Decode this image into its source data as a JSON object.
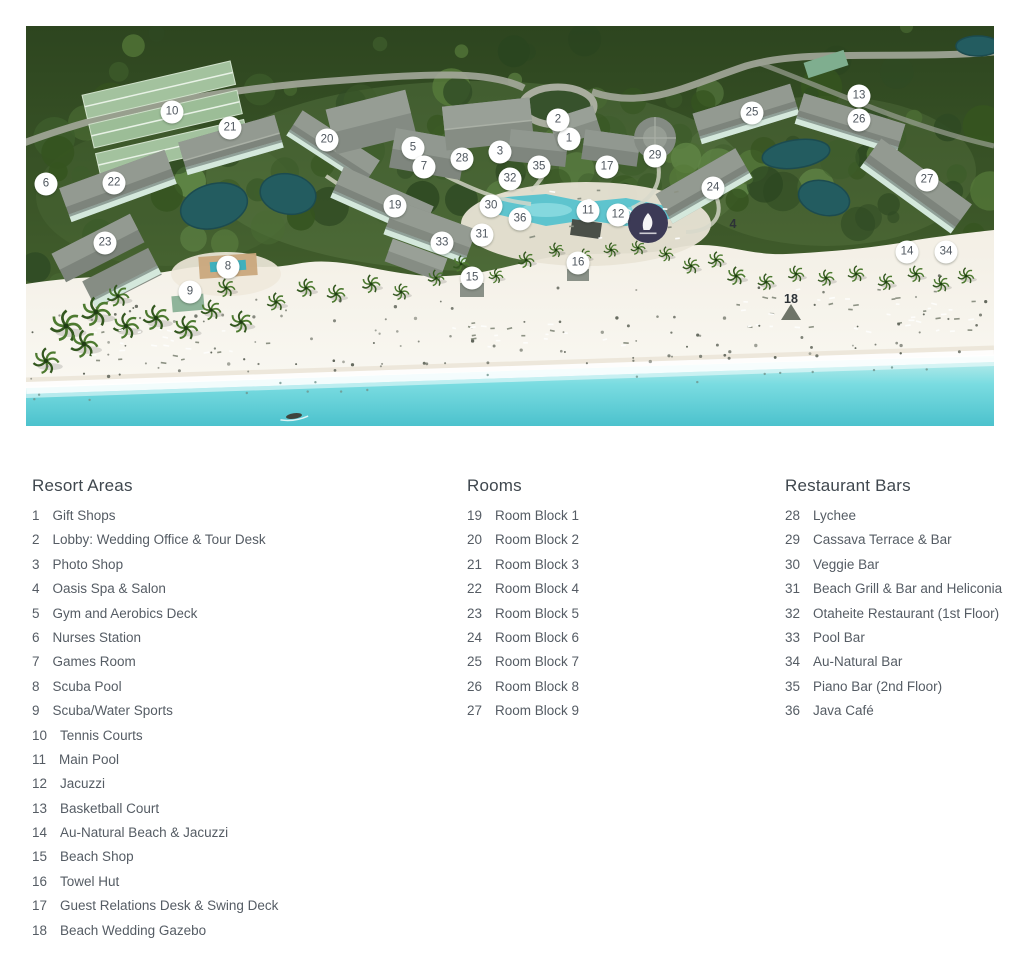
{
  "legend": {
    "columns": [
      {
        "heading": "Resort Areas",
        "items": [
          {
            "n": "1",
            "label": "Gift Shops"
          },
          {
            "n": "2",
            "label": "Lobby: Wedding Office & Tour Desk"
          },
          {
            "n": "3",
            "label": "Photo Shop"
          },
          {
            "n": "4",
            "label": "Oasis Spa & Salon"
          },
          {
            "n": "5",
            "label": "Gym and Aerobics Deck"
          },
          {
            "n": "6",
            "label": "Nurses Station"
          },
          {
            "n": "7",
            "label": "Games Room"
          },
          {
            "n": "8",
            "label": "Scuba Pool"
          },
          {
            "n": "9",
            "label": "Scuba/Water Sports"
          },
          {
            "n": "10",
            "label": "Tennis Courts"
          },
          {
            "n": "11",
            "label": "Main Pool"
          },
          {
            "n": "12",
            "label": "Jacuzzi"
          },
          {
            "n": "13",
            "label": "Basketball Court"
          },
          {
            "n": "14",
            "label": "Au-Natural Beach & Jacuzzi"
          },
          {
            "n": "15",
            "label": "Beach Shop"
          },
          {
            "n": "16",
            "label": "Towel Hut"
          },
          {
            "n": "17",
            "label": "Guest Relations Desk & Swing Deck"
          },
          {
            "n": "18",
            "label": "Beach Wedding Gazebo"
          }
        ]
      },
      {
        "heading": "Rooms",
        "items": [
          {
            "n": "19",
            "label": "Room Block 1"
          },
          {
            "n": "20",
            "label": "Room Block 2"
          },
          {
            "n": "21",
            "label": "Room Block 3"
          },
          {
            "n": "22",
            "label": "Room Block 4"
          },
          {
            "n": "23",
            "label": "Room Block 5"
          },
          {
            "n": "24",
            "label": "Room Block 6"
          },
          {
            "n": "25",
            "label": "Room Block 7"
          },
          {
            "n": "26",
            "label": "Room Block 8"
          },
          {
            "n": "27",
            "label": "Room Block 9"
          }
        ]
      },
      {
        "heading": "Restaurant Bars",
        "items": [
          {
            "n": "28",
            "label": "Lychee"
          },
          {
            "n": "29",
            "label": "Cassava Terrace & Bar"
          },
          {
            "n": "30",
            "label": "Veggie Bar"
          },
          {
            "n": "31",
            "label": "Beach Grill & Bar and Heliconia"
          },
          {
            "n": "32",
            "label": "Otaheite Restaurant (1st Floor)"
          },
          {
            "n": "33",
            "label": "Pool Bar"
          },
          {
            "n": "34",
            "label": "Au-Natural Bar"
          },
          {
            "n": "35",
            "label": "Piano Bar (2nd Floor)"
          },
          {
            "n": "36",
            "label": "Java Café"
          }
        ]
      }
    ]
  },
  "map": {
    "markers": [
      {
        "n": "1",
        "x": 543,
        "y": 113
      },
      {
        "n": "2",
        "x": 532,
        "y": 94
      },
      {
        "n": "3",
        "x": 474,
        "y": 126
      },
      {
        "n": "4",
        "x": 707,
        "y": 198,
        "plain": true
      },
      {
        "n": "5",
        "x": 387,
        "y": 122
      },
      {
        "n": "6",
        "x": 20,
        "y": 158
      },
      {
        "n": "7",
        "x": 398,
        "y": 141
      },
      {
        "n": "8",
        "x": 202,
        "y": 241
      },
      {
        "n": "9",
        "x": 164,
        "y": 266
      },
      {
        "n": "10",
        "x": 146,
        "y": 86
      },
      {
        "n": "11",
        "x": 562,
        "y": 185
      },
      {
        "n": "12",
        "x": 592,
        "y": 189
      },
      {
        "n": "13",
        "x": 833,
        "y": 70
      },
      {
        "n": "14",
        "x": 881,
        "y": 226
      },
      {
        "n": "15",
        "x": 446,
        "y": 252
      },
      {
        "n": "16",
        "x": 552,
        "y": 237
      },
      {
        "n": "17",
        "x": 581,
        "y": 141
      },
      {
        "n": "18",
        "x": 765,
        "y": 273,
        "plain": true
      },
      {
        "n": "19",
        "x": 369,
        "y": 180
      },
      {
        "n": "20",
        "x": 301,
        "y": 114
      },
      {
        "n": "21",
        "x": 204,
        "y": 102
      },
      {
        "n": "22",
        "x": 88,
        "y": 157
      },
      {
        "n": "23",
        "x": 79,
        "y": 217
      },
      {
        "n": "24",
        "x": 687,
        "y": 162
      },
      {
        "n": "25",
        "x": 726,
        "y": 87
      },
      {
        "n": "26",
        "x": 833,
        "y": 94
      },
      {
        "n": "27",
        "x": 901,
        "y": 154
      },
      {
        "n": "28",
        "x": 436,
        "y": 133
      },
      {
        "n": "29",
        "x": 629,
        "y": 130
      },
      {
        "n": "30",
        "x": 465,
        "y": 180
      },
      {
        "n": "31",
        "x": 456,
        "y": 209
      },
      {
        "n": "32",
        "x": 484,
        "y": 153
      },
      {
        "n": "33",
        "x": 416,
        "y": 217
      },
      {
        "n": "34",
        "x": 920,
        "y": 226
      },
      {
        "n": "35",
        "x": 513,
        "y": 141
      },
      {
        "n": "36",
        "x": 494,
        "y": 193
      }
    ],
    "colors": {
      "forest": "#3c5531",
      "sand": "#f7f4ed",
      "ocean": "#52c7d1",
      "pool": "#5ec4ce",
      "pond": "#235c60",
      "logo_badge": "#3c3a56"
    }
  }
}
